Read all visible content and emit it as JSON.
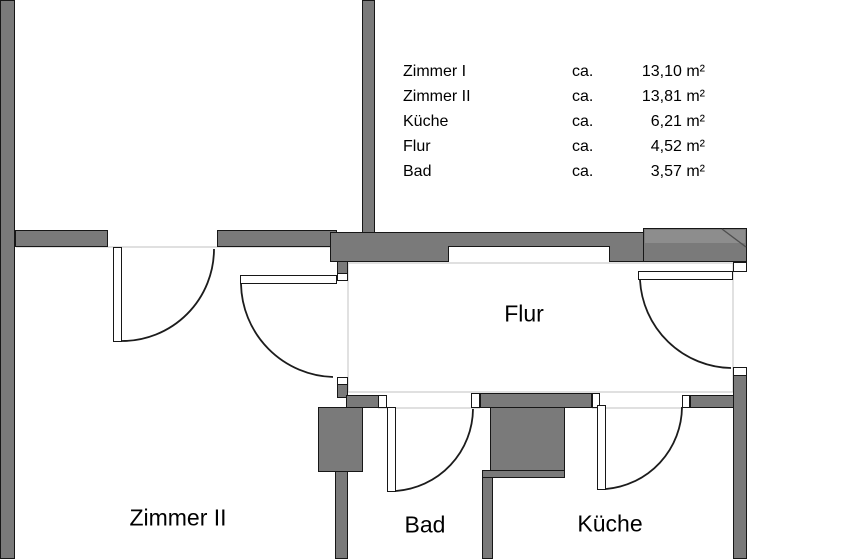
{
  "legend": {
    "rows": [
      {
        "label": "Zimmer I",
        "ca": "ca.",
        "value": "13,10 m²"
      },
      {
        "label": "Zimmer II",
        "ca": "ca.",
        "value": "13,81 m²"
      },
      {
        "label": "Küche",
        "ca": "ca.",
        "value": "6,21 m²"
      },
      {
        "label": "Flur",
        "ca": "ca.",
        "value": "4,52 m²"
      },
      {
        "label": "Bad",
        "ca": "ca.",
        "value": "3,57 m²"
      }
    ]
  },
  "rooms": {
    "flur": "Flur",
    "zimmer2": "Zimmer II",
    "bad": "Bad",
    "kueche": "Küche"
  },
  "colors": {
    "wall": "#7a7a7a",
    "wall_highlight": "#8d8d8d",
    "outline": "#171717",
    "faint_line": "#cdcdcd",
    "background": "#ffffff",
    "text": "#000000"
  }
}
